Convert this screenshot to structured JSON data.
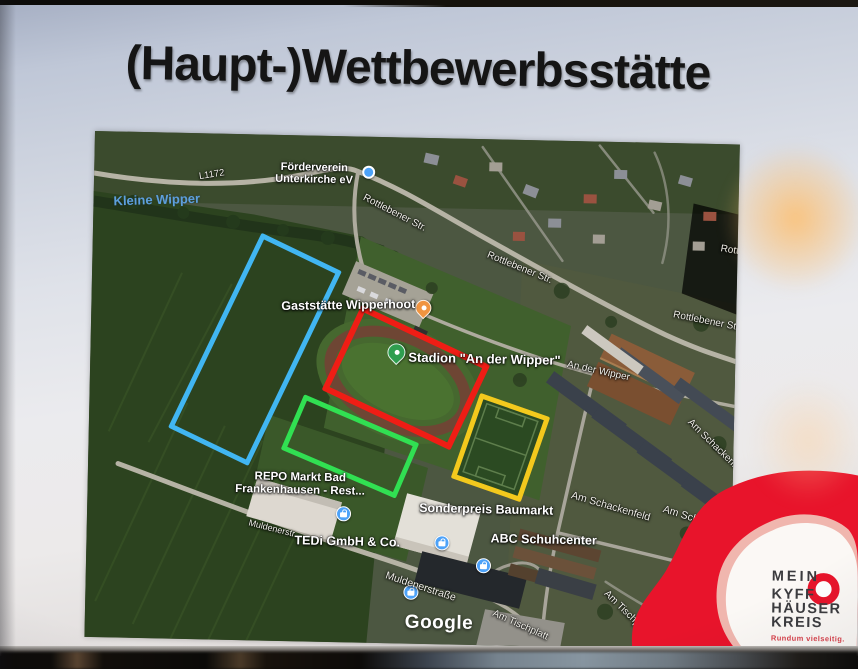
{
  "slide": {
    "title": "(Haupt-)Wettbewerbsstätte"
  },
  "map": {
    "provider_watermark": "Google",
    "water_label": "Kleine Wipper",
    "road_ref_label": "L1172",
    "street_labels": [
      {
        "text": "Rottlebener Str."
      },
      {
        "text": "Rottlebener Str."
      },
      {
        "text": "Rottlebener Str."
      },
      {
        "text": "Rottlebener Str."
      },
      {
        "text": "An der Wipper"
      },
      {
        "text": "Am Schackenfeld"
      },
      {
        "text": "Am Schackenfeld"
      },
      {
        "text": "Am Schackenfeld"
      },
      {
        "text": "Muldenerstr."
      },
      {
        "text": "Muldenerstraße"
      },
      {
        "text": "Am Tischplatt"
      },
      {
        "text": "Am Tischplatt"
      }
    ],
    "pois": {
      "foerderverein": {
        "line1": "Förderverein",
        "line2": "Unterkirche eV",
        "marker": "blue-dot"
      },
      "gaststaette": {
        "name": "Gaststätte Wipperhoot",
        "marker": "restaurant-pin"
      },
      "stadion": {
        "name": "Stadion \"An der Wipper\"",
        "marker": "green-pin"
      },
      "repo": {
        "line1": "REPO Markt Bad",
        "line2": "Frankenhausen - Rest...",
        "marker": "shopping-pin"
      },
      "sonderpreis": {
        "name": "Sonderpreis Baumarkt",
        "marker": "shopping-pin"
      },
      "abc": {
        "name": "ABC Schuhcenter",
        "marker": "shopping-pin"
      },
      "tedi": {
        "name": "TEDi GmbH & Co.",
        "marker": "shopping-pin"
      }
    },
    "zones": [
      {
        "id": "field-area",
        "color": "#41b6f2"
      },
      {
        "id": "stadium-area",
        "color": "#ef1d15"
      },
      {
        "id": "training-pitch-area",
        "color": "#31e052"
      },
      {
        "id": "soccer-pitch-area",
        "color": "#f3c91d"
      }
    ]
  },
  "logo": {
    "lines": [
      "MEIN",
      "KYFF",
      "HÄUSER",
      "KREIS"
    ],
    "tagline": "Rundum vielseitig.",
    "brand_color": "#e8142b"
  }
}
